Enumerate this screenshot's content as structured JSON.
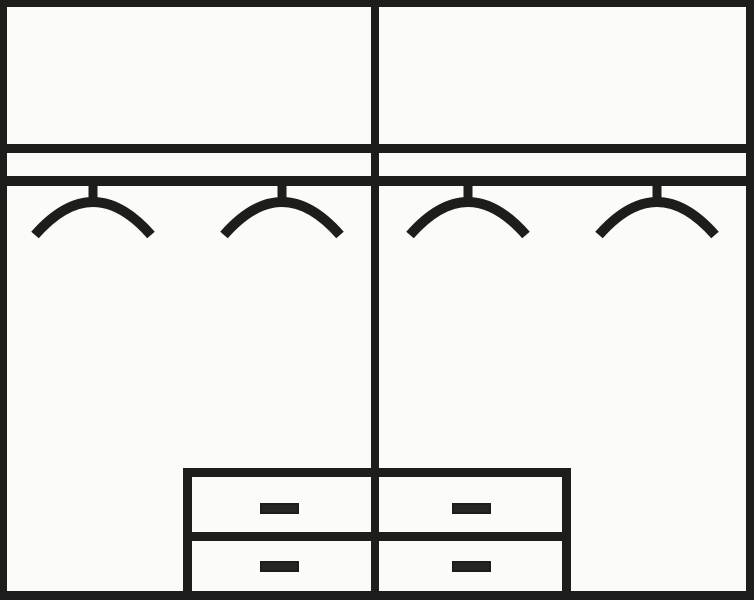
{
  "diagram": {
    "type": "wardrobe-interior-schematic",
    "description": "line drawing of wardrobe interior: top shelf compartments, hanging rail with four clothes hangers, and a two-by-two drawer unit",
    "canvas": {
      "width": 754,
      "height": 600
    },
    "colors": {
      "line": "#1d1d1b",
      "background": "#fbfbf9",
      "handle_fill": "#262624"
    },
    "frame_lines": [
      {
        "name": "outer-frame-top",
        "x": 0,
        "y": 0,
        "w": 754,
        "h": 7
      },
      {
        "name": "outer-frame-left",
        "x": 0,
        "y": 0,
        "w": 7,
        "h": 600
      },
      {
        "name": "outer-frame-right",
        "x": 746,
        "y": 0,
        "w": 8,
        "h": 600
      },
      {
        "name": "outer-frame-bottom",
        "x": 0,
        "y": 591,
        "w": 754,
        "h": 9
      },
      {
        "name": "center-divider",
        "x": 371,
        "y": 7,
        "w": 8,
        "h": 584
      },
      {
        "name": "shelf-line",
        "x": 7,
        "y": 144,
        "w": 739,
        "h": 9
      },
      {
        "name": "hanging-rail",
        "x": 7,
        "y": 176,
        "w": 739,
        "h": 10
      },
      {
        "name": "drawer-unit-left-edge",
        "x": 183,
        "y": 468,
        "w": 9,
        "h": 123
      },
      {
        "name": "drawer-unit-right-edge",
        "x": 562,
        "y": 468,
        "w": 9,
        "h": 123
      },
      {
        "name": "drawer-unit-top-edge",
        "x": 183,
        "y": 468,
        "w": 388,
        "h": 9
      },
      {
        "name": "drawer-divider-line",
        "x": 183,
        "y": 532,
        "w": 388,
        "h": 9
      }
    ],
    "regions": [
      {
        "name": "top-compartment-left",
        "x": 7,
        "y": 7,
        "w": 364,
        "h": 137
      },
      {
        "name": "top-compartment-right",
        "x": 379,
        "y": 7,
        "w": 367,
        "h": 137
      },
      {
        "name": "hanging-section-left",
        "x": 7,
        "y": 186,
        "w": 364,
        "h": 282
      },
      {
        "name": "hanging-section-right",
        "x": 379,
        "y": 186,
        "w": 367,
        "h": 282
      },
      {
        "name": "drawer-front-top-left",
        "x": 192,
        "y": 477,
        "w": 179,
        "h": 55
      },
      {
        "name": "drawer-front-top-right",
        "x": 379,
        "y": 477,
        "w": 183,
        "h": 55
      },
      {
        "name": "drawer-front-bottom-left",
        "x": 192,
        "y": 541,
        "w": 179,
        "h": 50
      },
      {
        "name": "drawer-front-bottom-right",
        "x": 379,
        "y": 541,
        "w": 183,
        "h": 50
      }
    ],
    "hangers": {
      "count": 4,
      "geometry": {
        "top": 184,
        "width": 130,
        "height": 64,
        "stem_length": 20,
        "stem_stroke": 9,
        "hook_half_width": 58,
        "hook_stroke": 10,
        "tip_y": 51,
        "ctrl_y": -15
      },
      "items": [
        {
          "name": "hanger-icon-1",
          "cx": 93
        },
        {
          "name": "hanger-icon-2",
          "cx": 281.5
        },
        {
          "name": "hanger-icon-3",
          "cx": 468
        },
        {
          "name": "hanger-icon-4",
          "cx": 656.5
        }
      ]
    },
    "drawer_handles": {
      "count": 4,
      "geometry": {
        "w": 39,
        "h": 11,
        "border": 2
      },
      "items": [
        {
          "name": "drawer-handle-top-left",
          "cx": 279.5,
          "cy": 508
        },
        {
          "name": "drawer-handle-top-right",
          "cx": 471.5,
          "cy": 508
        },
        {
          "name": "drawer-handle-bottom-left",
          "cx": 279.5,
          "cy": 566.5
        },
        {
          "name": "drawer-handle-bottom-right",
          "cx": 471.5,
          "cy": 566.5
        }
      ]
    }
  }
}
